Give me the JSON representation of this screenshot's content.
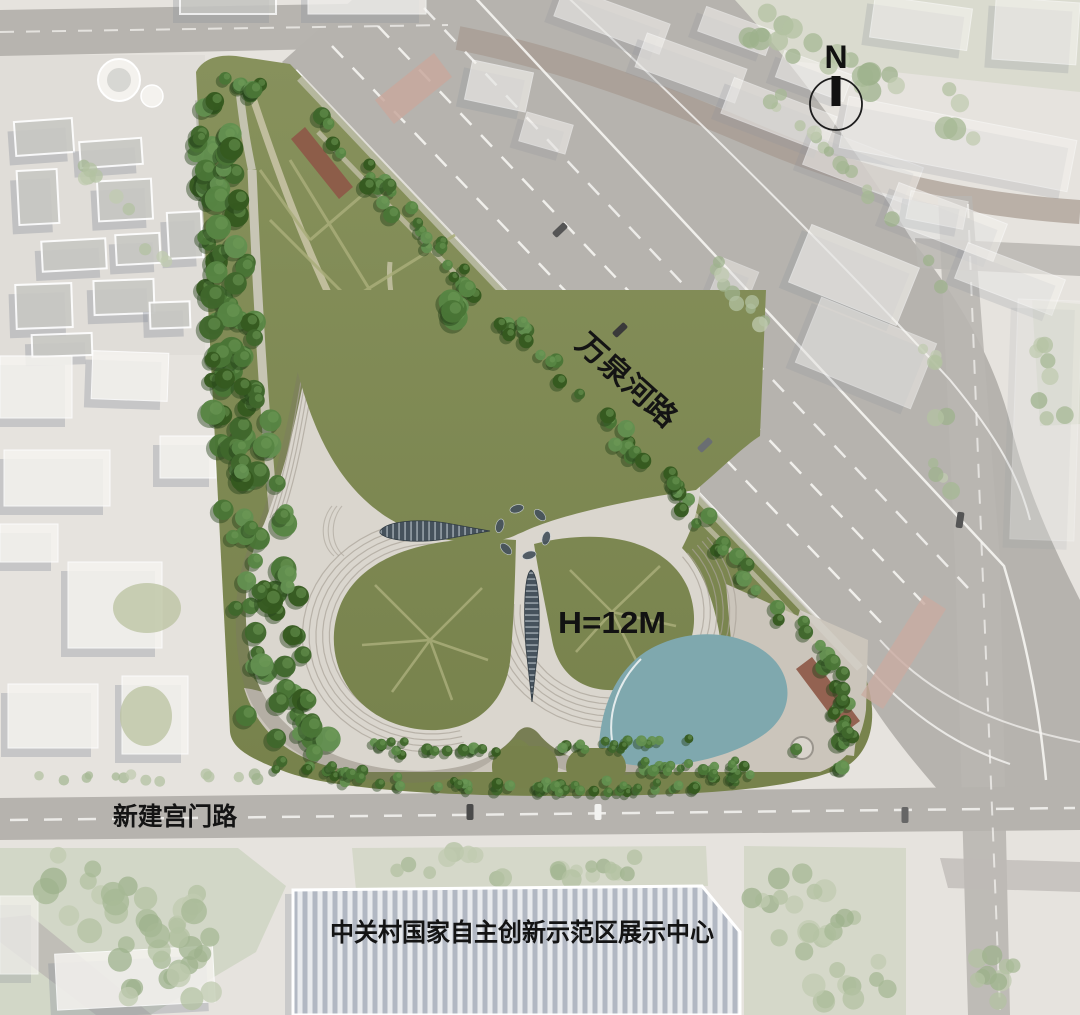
{
  "view": {
    "type": "aerial-site-plan-rendering",
    "subject": "flower-shaped exhibition building in triangular park"
  },
  "labels": {
    "road_diagonal": "万泉河路",
    "road_bottom": "新建宫门路",
    "building_height": "H=12M",
    "exhibition_center": "中关村国家自主创新示范区展示中心",
    "north_marker": "N"
  },
  "icons": {
    "north_arrow": "north-arrow"
  },
  "colors": {
    "lawn_top": "#87915c",
    "lawn_bottom": "#76814b",
    "vein": "#a9ad7a",
    "tree_dark": "#46702f",
    "tree_faded": "#b3c2a2",
    "pond": "#7fa8ae",
    "road": "#b7b4af",
    "road_secondary": "#a79a90",
    "context_ground": "#e6e3de",
    "context_green": "#cdd3c0",
    "building_shell": "#dad6ce",
    "skylight": "#46525c",
    "bus_stop_red": "#8e5948",
    "crosswalk_pink": "#c8a89e",
    "exhibition_stripe": "#b2b8c3",
    "label_text": "#141414"
  }
}
